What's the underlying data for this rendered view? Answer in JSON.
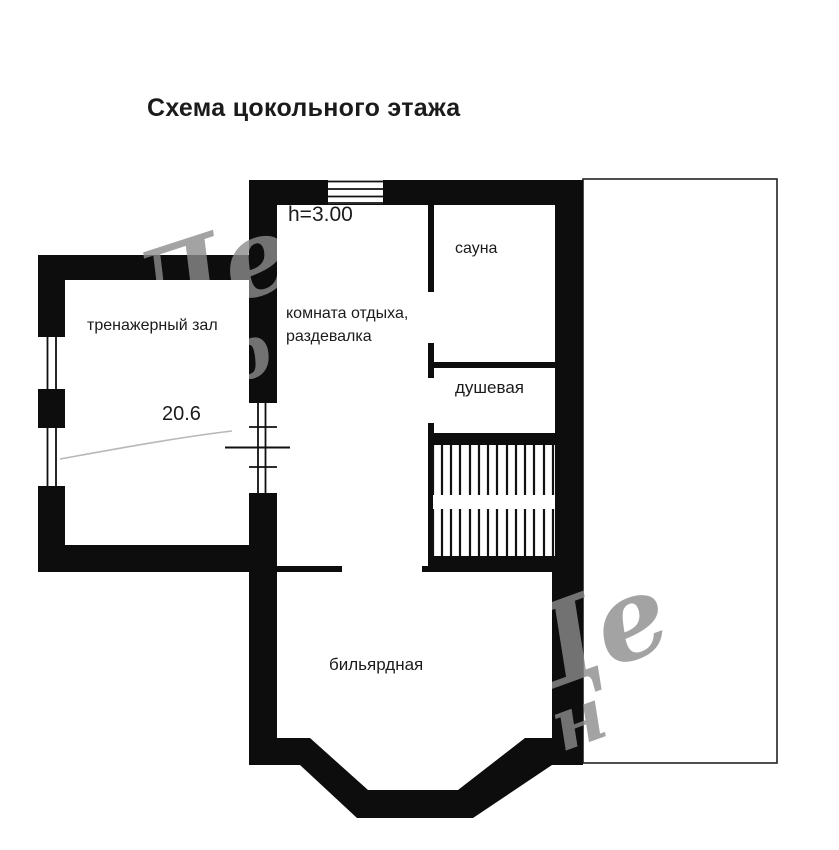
{
  "title": "Схема цокольного этажа",
  "plan": {
    "height_note": "h=3.00",
    "rooms": {
      "gym": {
        "label": "тренажерный зал",
        "area": "20.6"
      },
      "lounge": {
        "label_line1": "комната отдыха,",
        "label_line2": "раздевалка"
      },
      "sauna": {
        "label": "сауна"
      },
      "shower": {
        "label": "душевая"
      },
      "billiard": {
        "label": "бильярдная"
      }
    }
  },
  "watermark": {
    "fragments": {
      "a1": "Де",
      "a2": "пр",
      "b1": "Де",
      "b2": "н"
    }
  },
  "colors": {
    "background": "#ffffff",
    "wall": "#0d0d0d",
    "text": "#1b1b1b",
    "watermark": "#8d8d8d"
  }
}
